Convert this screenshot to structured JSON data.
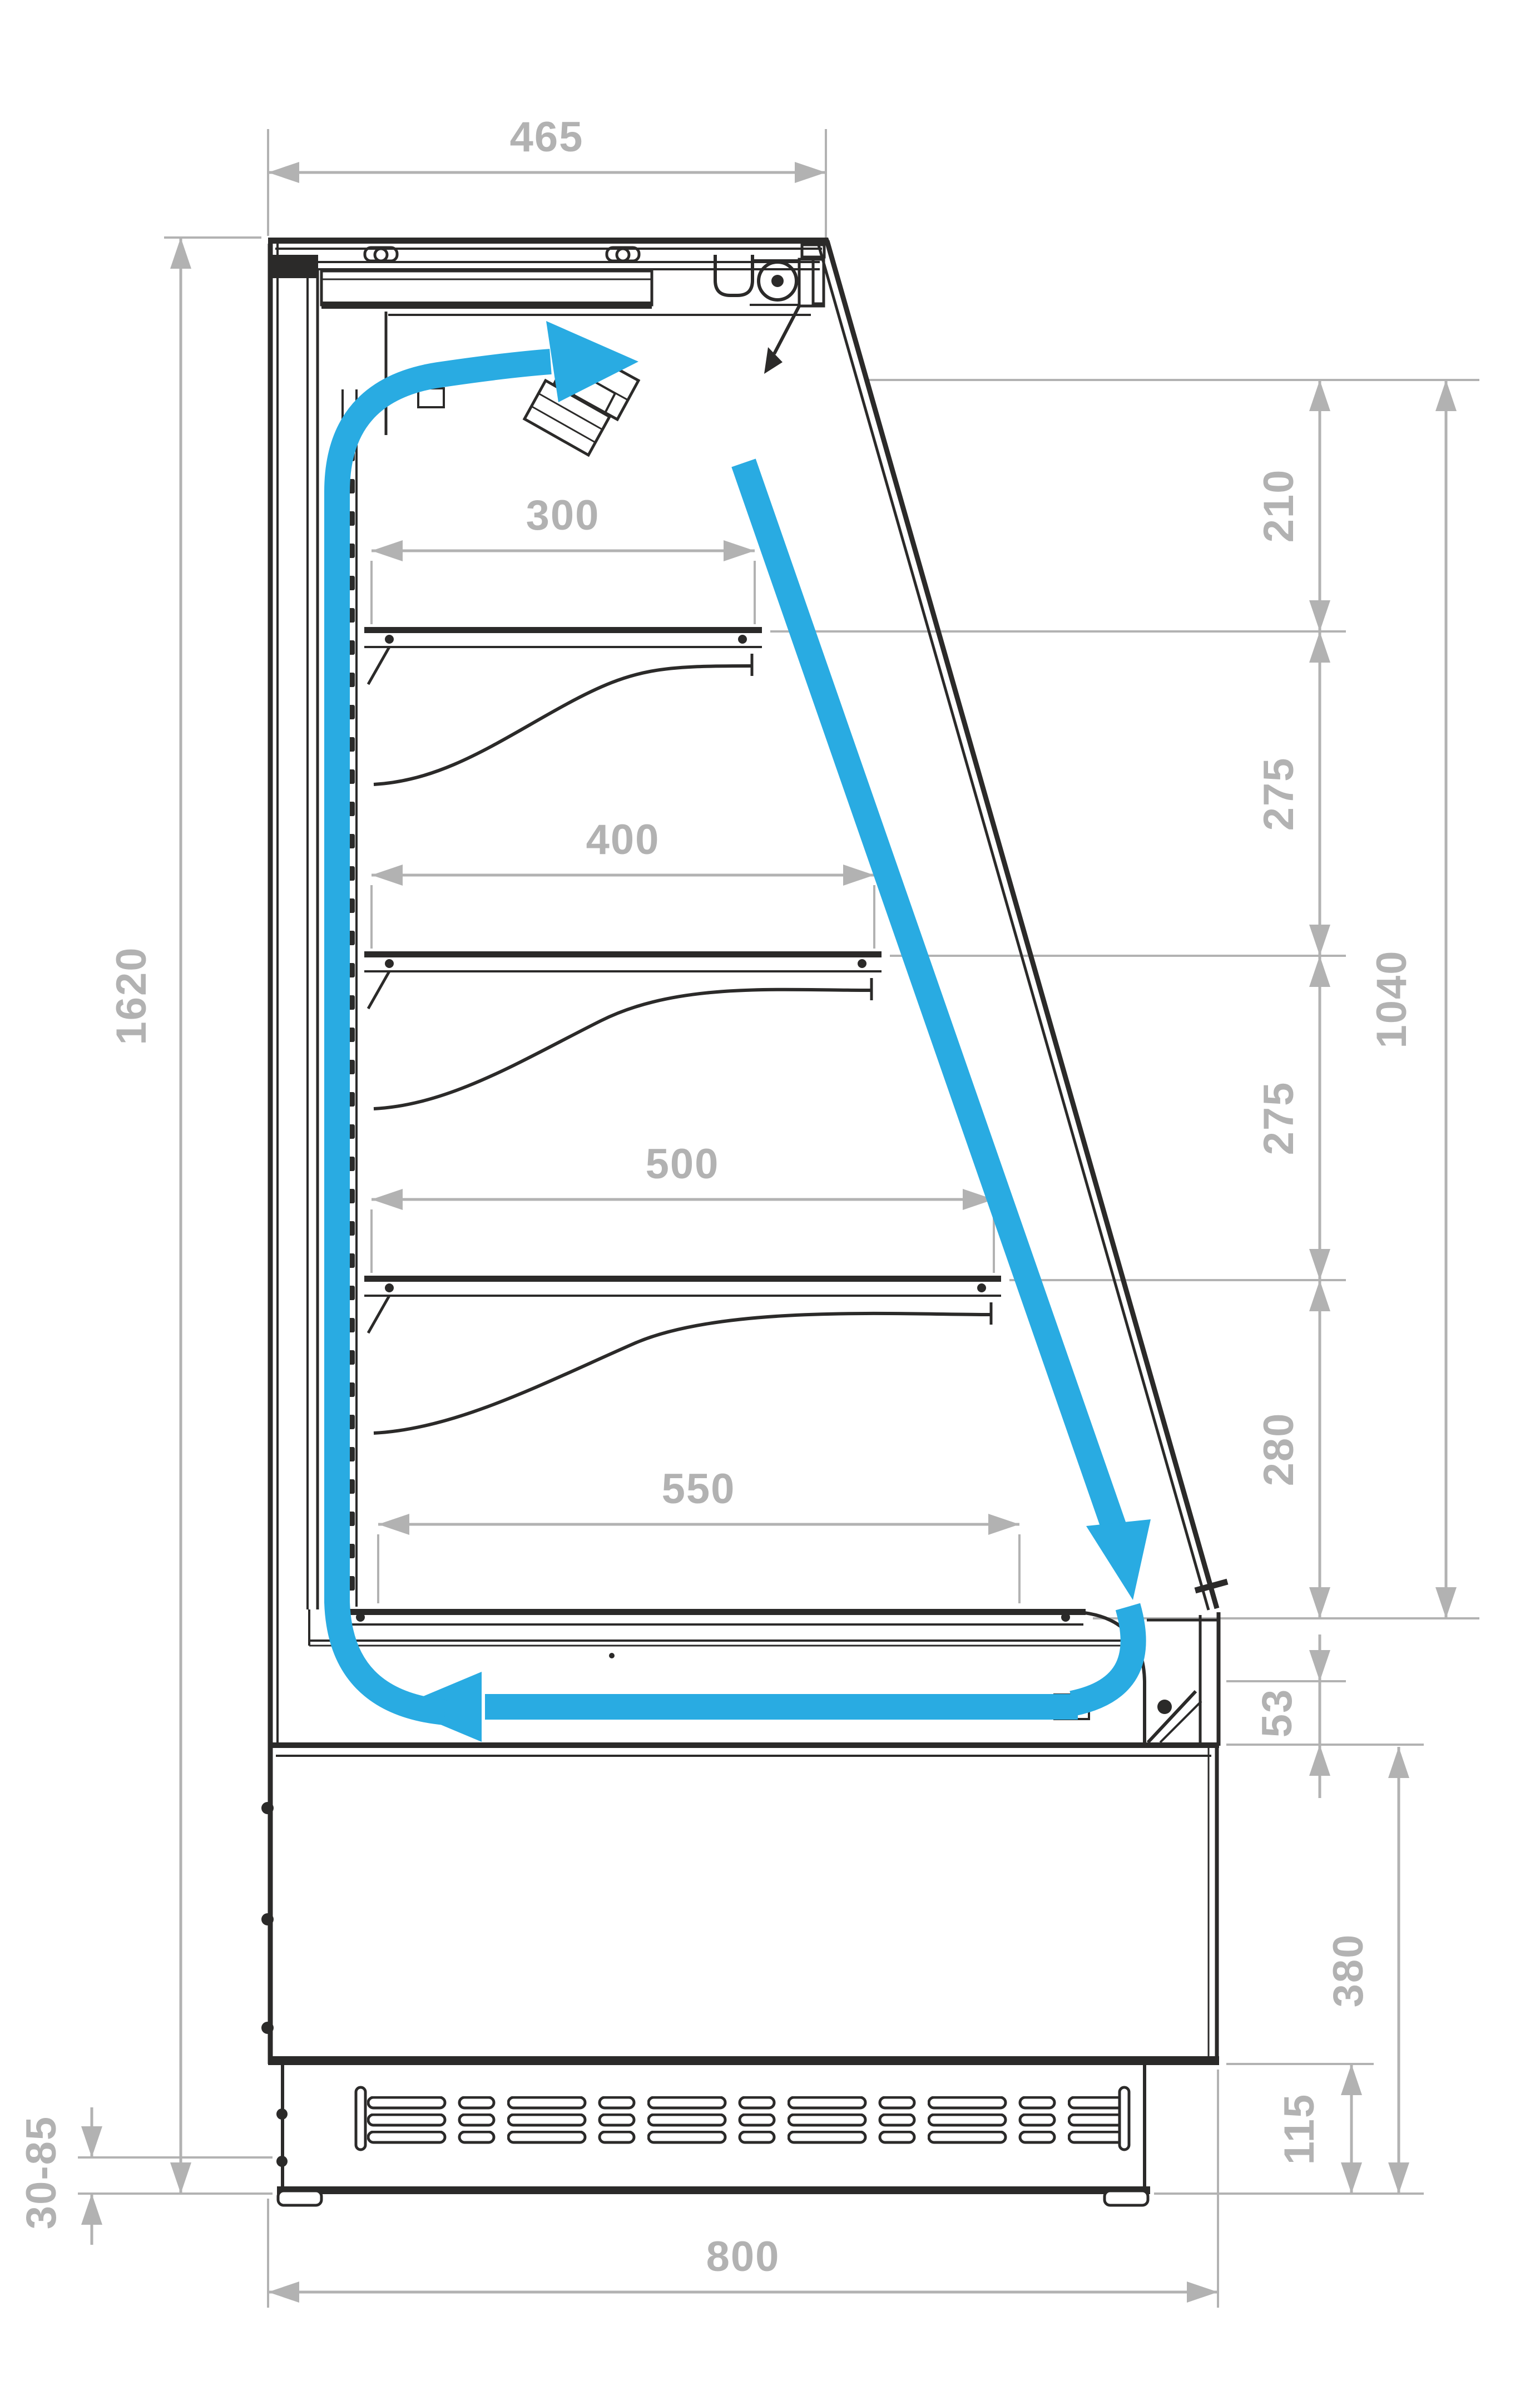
{
  "diagram": {
    "type": "technical-drawing",
    "subject": "Refrigerated display case side cross-section with air circulation arrows",
    "units": "mm",
    "colors": {
      "outline": "#2b2a29",
      "dimension_gray": "#b2b2b2",
      "airflow_blue": "#29abe2",
      "background": "#ffffff"
    },
    "dimensions": {
      "top_depth": "465",
      "glass_section_1": "210",
      "glass_section_2": "275",
      "glass_section_3": "275",
      "glass_section_4": "280",
      "glass_overall": "1040",
      "shelf_1_depth": "300",
      "shelf_2_depth": "400",
      "shelf_3_depth": "500",
      "bottom_shelf_depth": "550",
      "overall_height": "1620",
      "front_air_gap": "53",
      "base_section_height": "380",
      "plinth_height": "115",
      "feet_adjustment_range": "30-85",
      "overall_depth": "800"
    }
  }
}
